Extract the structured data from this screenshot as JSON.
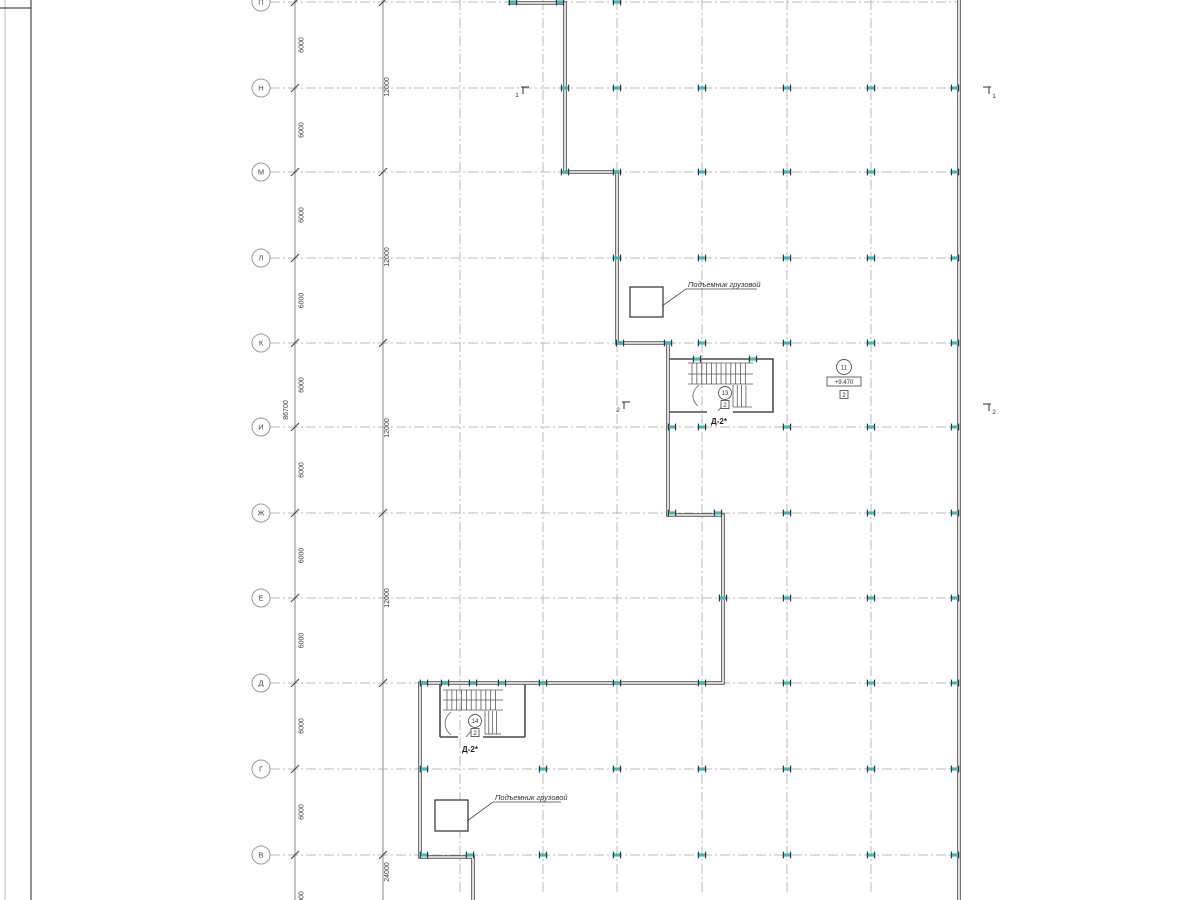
{
  "drawing": {
    "row_labels": [
      "П",
      "Н",
      "М",
      "Л",
      "К",
      "И",
      "Ж",
      "Е",
      "Д",
      "Г",
      "В"
    ],
    "dim_6000_labels": [
      "6000",
      "6000",
      "6000",
      "6000",
      "6000",
      "6000",
      "6000",
      "6000",
      "6000",
      "6000",
      "6000"
    ],
    "dim_12000_labels": [
      "12000",
      "12000",
      "12000",
      "12000"
    ],
    "dim_total": "86700",
    "dim_bottom": "24000",
    "lift_label_upper": "Подъемник грузовой",
    "lift_label_lower": "Подъемник грузовой",
    "stair_upper": {
      "circle": "13",
      "box": "2",
      "label": "Д-2*"
    },
    "stair_lower": {
      "circle": "14",
      "box": "2",
      "label": "Д-2*"
    },
    "right_callout": {
      "circle": "11",
      "elevation": "+9.470",
      "box": "2"
    },
    "section_marks": [
      {
        "label": "1"
      },
      {
        "label": "1"
      },
      {
        "label": "2"
      },
      {
        "label": "2"
      }
    ],
    "colors": {
      "wall": "#4f4f4f",
      "grid": "#b8b8b8",
      "dim_line": "#8a8a8a",
      "column": "#45b5b5",
      "text": "#333333"
    }
  }
}
